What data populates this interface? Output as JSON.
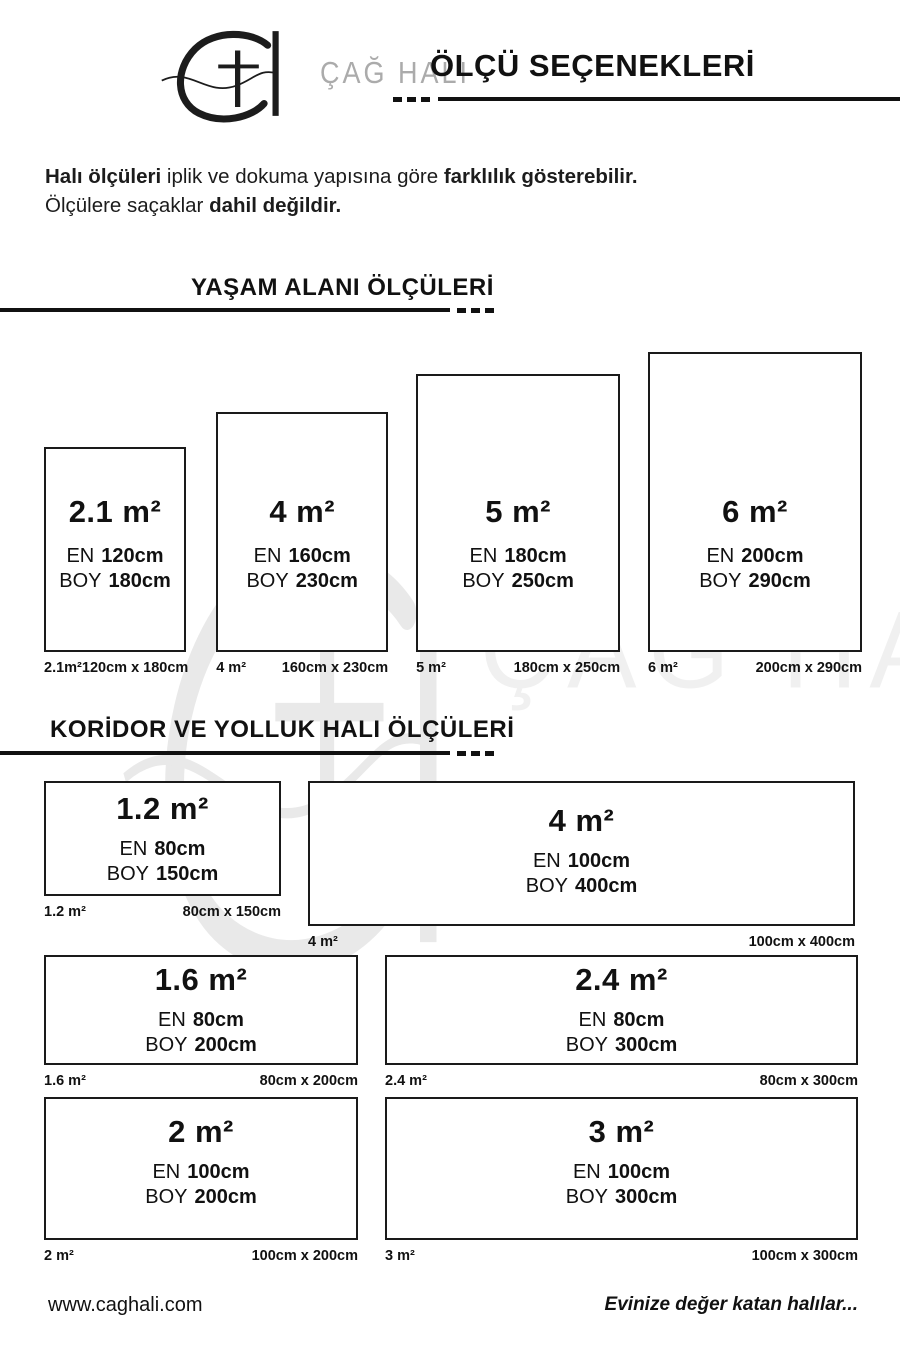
{
  "header": {
    "brand_name": "ÇAĞ HALI",
    "title": "ÖLÇÜ SEÇENEKLERİ"
  },
  "intro": {
    "line1_bold1": "Halı ölçüleri",
    "line1_regular": " iplik ve dokuma yapısına göre ",
    "line1_bold2": "farklılık gösterebilir.",
    "line2_regular": "Ölçülere saçaklar ",
    "line2_bold": "dahil değildir."
  },
  "labels": {
    "en": "EN",
    "boy": "BOY"
  },
  "sections": [
    {
      "heading": "YAŞAM ALANI ÖLÇÜLERİ",
      "items": [
        {
          "area": "2.1 m²",
          "en": "120cm",
          "boy": "180cm",
          "caption_left": "2.1m²",
          "caption_right": "120cm x 180cm"
        },
        {
          "area": "4 m²",
          "en": "160cm",
          "boy": "230cm",
          "caption_left": "4 m²",
          "caption_right": "160cm x 230cm"
        },
        {
          "area": "5 m²",
          "en": "180cm",
          "boy": "250cm",
          "caption_left": "5 m²",
          "caption_right": "180cm x 250cm"
        },
        {
          "area": "6 m²",
          "en": "200cm",
          "boy": "290cm",
          "caption_left": "6 m²",
          "caption_right": "200cm x 290cm"
        }
      ]
    },
    {
      "heading": "KORİDOR VE YOLLUK HALI ÖLÇÜLERİ",
      "items": [
        {
          "area": "1.2 m²",
          "en": "80cm",
          "boy": "150cm",
          "caption_left": "1.2 m²",
          "caption_right": "80cm x 150cm"
        },
        {
          "area": "4 m²",
          "en": "100cm",
          "boy": "400cm",
          "caption_left": "4 m²",
          "caption_right": "100cm x 400cm"
        },
        {
          "area": "1.6 m²",
          "en": "80cm",
          "boy": "200cm",
          "caption_left": "1.6 m²",
          "caption_right": "80cm x 200cm"
        },
        {
          "area": "2.4 m²",
          "en": "80cm",
          "boy": "300cm",
          "caption_left": "2.4 m²",
          "caption_right": "80cm x 300cm"
        },
        {
          "area": "2 m²",
          "en": "100cm",
          "boy": "200cm",
          "caption_left": "2 m²",
          "caption_right": "100cm x 200cm"
        },
        {
          "area": "3 m²",
          "en": "100cm",
          "boy": "300cm",
          "caption_left": "3 m²",
          "caption_right": "100cm x 300cm"
        }
      ]
    }
  ],
  "footer": {
    "website": "www.caghali.com",
    "slogan": "Evinize değer katan halılar..."
  },
  "watermark": {
    "brand_name": "ÇAĞ HALI"
  },
  "colors": {
    "ink": "#111111",
    "brand_gray": "#ababab",
    "watermark": "#ededed"
  }
}
